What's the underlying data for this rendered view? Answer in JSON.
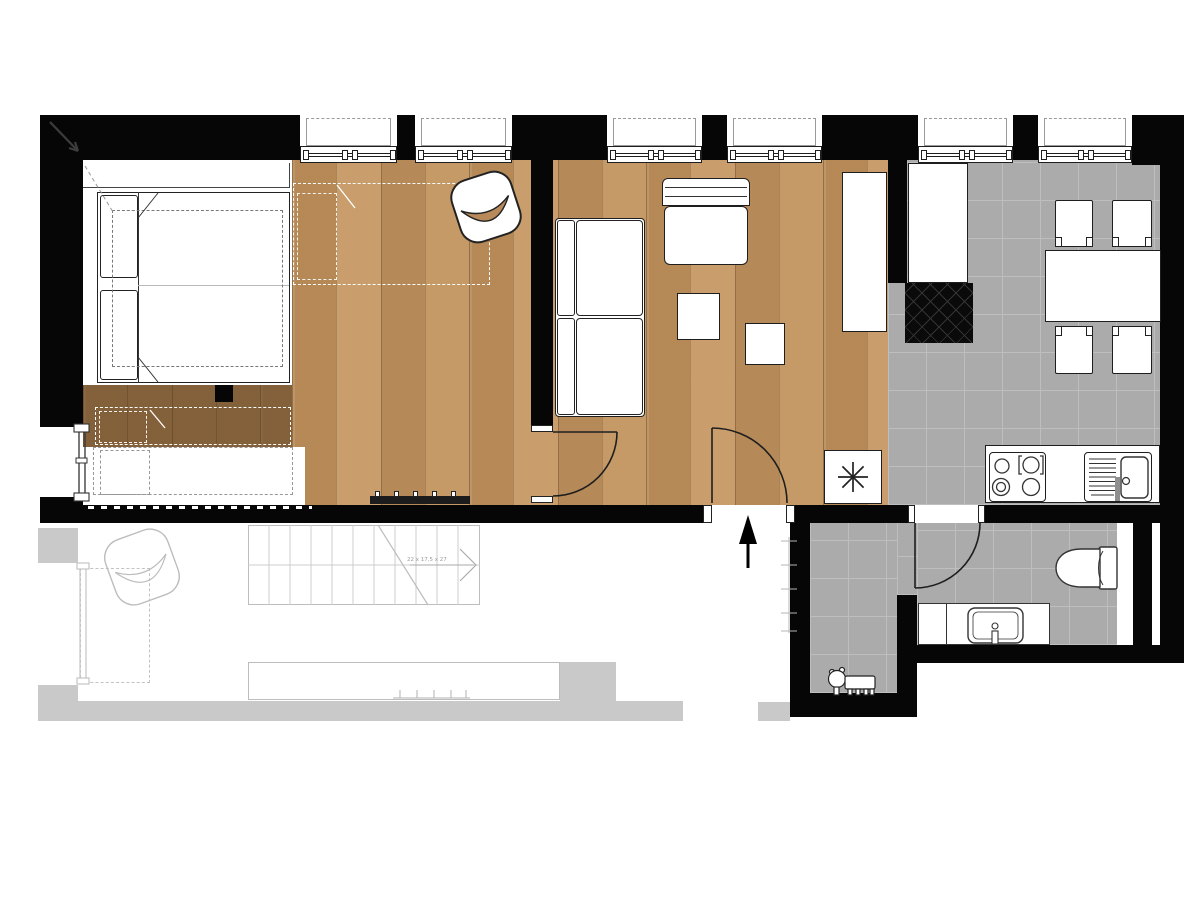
{
  "document": {
    "kind": "apartment floor plan"
  },
  "colors": {
    "wall": "#060606",
    "wood_floor": "#c0935f",
    "wood_floor_shadow": "#8f6c42",
    "tile_floor": "#ababab",
    "tile_grid_line": "#bebebe",
    "ghost_lower_level": "#c9c9c9",
    "furniture_fill": "#ffffff",
    "furniture_line": "#222222"
  },
  "windows": {
    "count": 6
  },
  "stairs": {
    "dimension_label": "22 x 17,5 x 27"
  },
  "icons": {
    "entrance_arrow": "▲",
    "heater_symbol": "✳",
    "north_arrow": "↘"
  }
}
